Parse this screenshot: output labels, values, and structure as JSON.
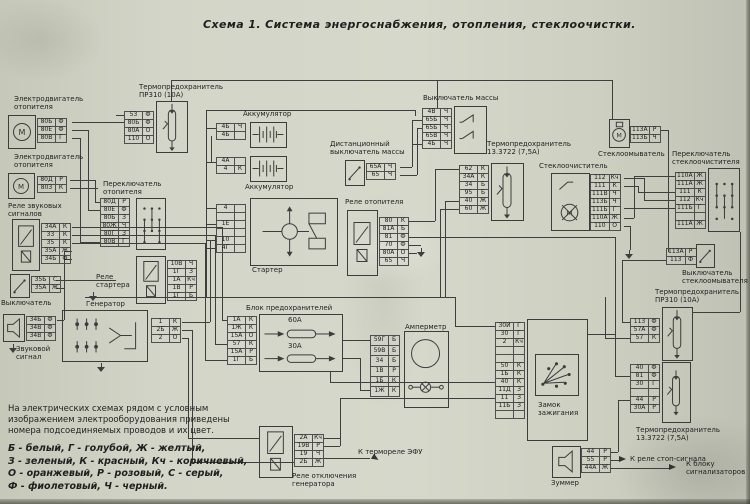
{
  "title": "Схема 1. Система энергоснабжения, отопления, стеклоочистки.",
  "note": "На электрических схемах рядом с условным изображением электрооборудования приведены номера подсоединяемых проводов и их цвет.",
  "color_legend": "Б - белый, Г - голубой, Ж - желтый,\nЗ - зеленый, К - красный, Кч - коричневый,\nО - оранжевый, Р - розовый, С - серый,\nФ - фиолетовый, Ч - черный.",
  "icons": {
    "motor_letter": "М"
  },
  "annotations": {
    "efu": "К термореле ЭФУ",
    "stop": "К реле стоп-сигнала",
    "signal_block": "К блоку\nсигнализаторов"
  },
  "components": [
    {
      "id": "heater-motor-1",
      "label": "Электродвигатель\nотопителя",
      "pins": [
        [
          "80Б",
          "Ф"
        ],
        [
          "80Е",
          "Ф"
        ],
        [
          "80В",
          "Г"
        ]
      ]
    },
    {
      "id": "heater-motor-2",
      "label": "Электродвигатель\nотопителя",
      "pins": [
        [
          "80Д",
          "Р"
        ],
        [
          "80З",
          "К"
        ]
      ]
    },
    {
      "id": "horn-relay",
      "label": "Реле звуковых\nсигналов",
      "pins": [
        [
          "34А",
          "К"
        ],
        [
          "33",
          "К"
        ],
        [
          "35",
          "К"
        ],
        [
          "35А",
          "Ж"
        ],
        [
          "34Б",
          "Ф"
        ]
      ]
    },
    {
      "id": "horn-switch",
      "label": "Выключатель",
      "pins": [
        [
          "35Б",
          "С"
        ],
        [
          "35А",
          "Ж"
        ]
      ]
    },
    {
      "id": "horn",
      "label": "Звуковой\nсигнал",
      "pins": [
        [
          "34Б",
          "Ф"
        ],
        [
          "34В",
          "Ф"
        ],
        [
          "34В",
          "Ф"
        ]
      ]
    },
    {
      "id": "thermal-fuse-top",
      "label": "Термопредохранитель\nПР310 (10А)",
      "pins": [
        [
          "53",
          "Ф"
        ],
        [
          "80Б",
          "Ф"
        ],
        [
          "80А",
          "О"
        ],
        [
          "110",
          "О"
        ]
      ]
    },
    {
      "id": "heater-switch",
      "label": "Переключатель\nотопителя",
      "pins": [
        [
          "80Д",
          "Р"
        ],
        [
          "80Е",
          "Ф"
        ],
        [
          "80Б",
          "З"
        ],
        [
          "80Ж",
          "Ч"
        ],
        [
          "80Г",
          "З"
        ],
        [
          "80В",
          "Г"
        ]
      ]
    },
    {
      "id": "starter-relay",
      "label": "Реле\nстартера",
      "pins": [
        [
          "10В",
          "Ч"
        ],
        [
          "1Г",
          "З"
        ],
        [
          "1А",
          "Кч"
        ],
        [
          "1В",
          "Р"
        ],
        [
          "1Г",
          "Б"
        ]
      ]
    },
    {
      "id": "generator",
      "label": "Генератор",
      "pins": [
        [
          "1",
          "К"
        ],
        [
          "2Б",
          "Ж"
        ],
        [
          "2",
          "О"
        ]
      ]
    },
    {
      "id": "battery-1",
      "label": "Аккумулятор",
      "pins": [
        [
          "4Б",
          "Ч"
        ],
        [
          "4Б",
          ""
        ]
      ]
    },
    {
      "id": "battery-2",
      "label": "Аккумулятор",
      "pins": [
        [
          "4А",
          ""
        ],
        [
          "4",
          "К"
        ]
      ]
    },
    {
      "id": "starter",
      "label": "Стартер",
      "pins": [
        [
          "4",
          ""
        ],
        [
          "",
          ""
        ],
        [
          "1Е",
          ""
        ],
        [
          "",
          ""
        ],
        [
          "10",
          ""
        ],
        [
          "4Г",
          ""
        ]
      ]
    },
    {
      "id": "remote-ground-switch",
      "label": "Дистанционный\nвыключатель массы",
      "pins": [
        [
          "65А",
          "Ч"
        ],
        [
          "65",
          "Ч"
        ]
      ]
    },
    {
      "id": "ground-switch",
      "label": "Выключатель массы",
      "pins": [
        [
          "4В",
          "Ч"
        ],
        [
          "65Б",
          "Ч"
        ],
        [
          "65Б",
          "Ч"
        ],
        [
          "65В",
          "Ч"
        ],
        [
          "4Б",
          "Ч"
        ]
      ]
    },
    {
      "id": "thermal-fuse-mid",
      "label": "Термопредохранитель\n13.3722 (7,5А)",
      "pins": [
        [
          "62",
          "К"
        ],
        [
          "34А",
          "К"
        ],
        [
          "34",
          "Б"
        ],
        [
          "95",
          "Б"
        ],
        [
          "40",
          "Ж"
        ],
        [
          "60",
          "Ж"
        ]
      ]
    },
    {
      "id": "heater-relay",
      "label": "Реле отопителя",
      "pins": [
        [
          "80",
          "К"
        ],
        [
          "81А",
          "Б"
        ],
        [
          "81",
          "Ф"
        ],
        [
          "70",
          "Ф"
        ],
        [
          "80А",
          "О"
        ],
        [
          "65",
          "Ч"
        ]
      ]
    },
    {
      "id": "wiper",
      "label": "Стеклоочиститель",
      "pins": [
        [
          "112",
          "Кч"
        ],
        [
          "111",
          "К"
        ],
        [
          "111В",
          "Ч"
        ],
        [
          "113Б",
          "Ч"
        ],
        [
          "111Б",
          "Г"
        ],
        [
          "110А",
          "Ж"
        ],
        [
          "110",
          "О"
        ]
      ]
    },
    {
      "id": "washer",
      "label": "Стеклоомыватель",
      "pins": [
        [
          "113А",
          "Р"
        ],
        [
          "113Б",
          "Ч"
        ]
      ]
    },
    {
      "id": "wiper-switch",
      "label": "Переключатель\nстеклоочистителя",
      "pins": [
        [
          "110А",
          "Ж"
        ],
        [
          "111А",
          "Ж"
        ],
        [
          "111",
          "К"
        ],
        [
          "112",
          "Кч"
        ],
        [
          "111Б",
          "Г"
        ],
        [
          "",
          ""
        ],
        [
          "111А",
          "Ж"
        ]
      ]
    },
    {
      "id": "washer-switch",
      "label": "Выключатель\nстеклоомывателя",
      "pins": [
        [
          "113А",
          "Р"
        ],
        [
          "113",
          "Ф"
        ]
      ]
    },
    {
      "id": "thermal-fuse-right",
      "label": "Термопредохранитель\nПР310 (10А)",
      "pins": [
        [
          "113",
          "Ф"
        ],
        [
          "57А",
          "Ф"
        ],
        [
          "57",
          "К"
        ]
      ]
    },
    {
      "id": "thermal-fuse-bottom",
      "label": "Термопредохранитель\n13.3722 (7,5А)",
      "pins": [
        [
          "40",
          "Ф"
        ],
        [
          "81",
          "Ф"
        ],
        [
          "30",
          "Г"
        ],
        [
          "",
          ""
        ],
        [
          "44",
          "Р"
        ],
        [
          "30А",
          "Р"
        ]
      ]
    },
    {
      "id": "fuse-block",
      "label": "Блок предохранителей",
      "pins": [
        [
          "1А",
          "К"
        ],
        [
          "1Ж",
          "К"
        ],
        [
          "15А",
          "О"
        ],
        [
          "57",
          "К"
        ],
        [
          "15А",
          "Р"
        ],
        [
          "1Г",
          "Б"
        ]
      ],
      "fuses": [
        "60А",
        "30А"
      ]
    },
    {
      "id": "ammeter",
      "label": "Амперметр",
      "pins": [
        [
          "59Г",
          "Б"
        ],
        [
          "59В",
          "Б"
        ],
        [
          "34",
          "Б"
        ],
        [
          "1В",
          "Р"
        ],
        [
          "1Б",
          "К"
        ],
        [
          "1Ж",
          "К"
        ]
      ]
    },
    {
      "id": "ignition",
      "label": "Замок\nзажигания",
      "pins": [
        [
          "30И",
          "Г"
        ],
        [
          "30",
          "Г"
        ],
        [
          "2",
          "Кч"
        ],
        [
          "",
          ""
        ],
        [
          "",
          ""
        ],
        [
          "50",
          "К"
        ],
        [
          "1Б",
          "К"
        ],
        [
          "40",
          "К"
        ],
        [
          "11Д",
          "З"
        ],
        [
          "11",
          "З"
        ],
        [
          "11Б",
          "З"
        ],
        [
          "",
          ""
        ]
      ]
    },
    {
      "id": "buzzer",
      "label": "Зуммер",
      "pins": [
        [
          "44",
          "Р"
        ],
        [
          "55",
          "Р"
        ],
        [
          "44А",
          "Ж"
        ]
      ]
    },
    {
      "id": "gen-relay",
      "label": "Реле отключения\nгенератора",
      "pins": [
        [
          "2А",
          "Кч"
        ],
        [
          "19В",
          "Р"
        ],
        [
          "19",
          "Ч"
        ],
        [
          "2Б",
          "Ж"
        ]
      ]
    }
  ]
}
